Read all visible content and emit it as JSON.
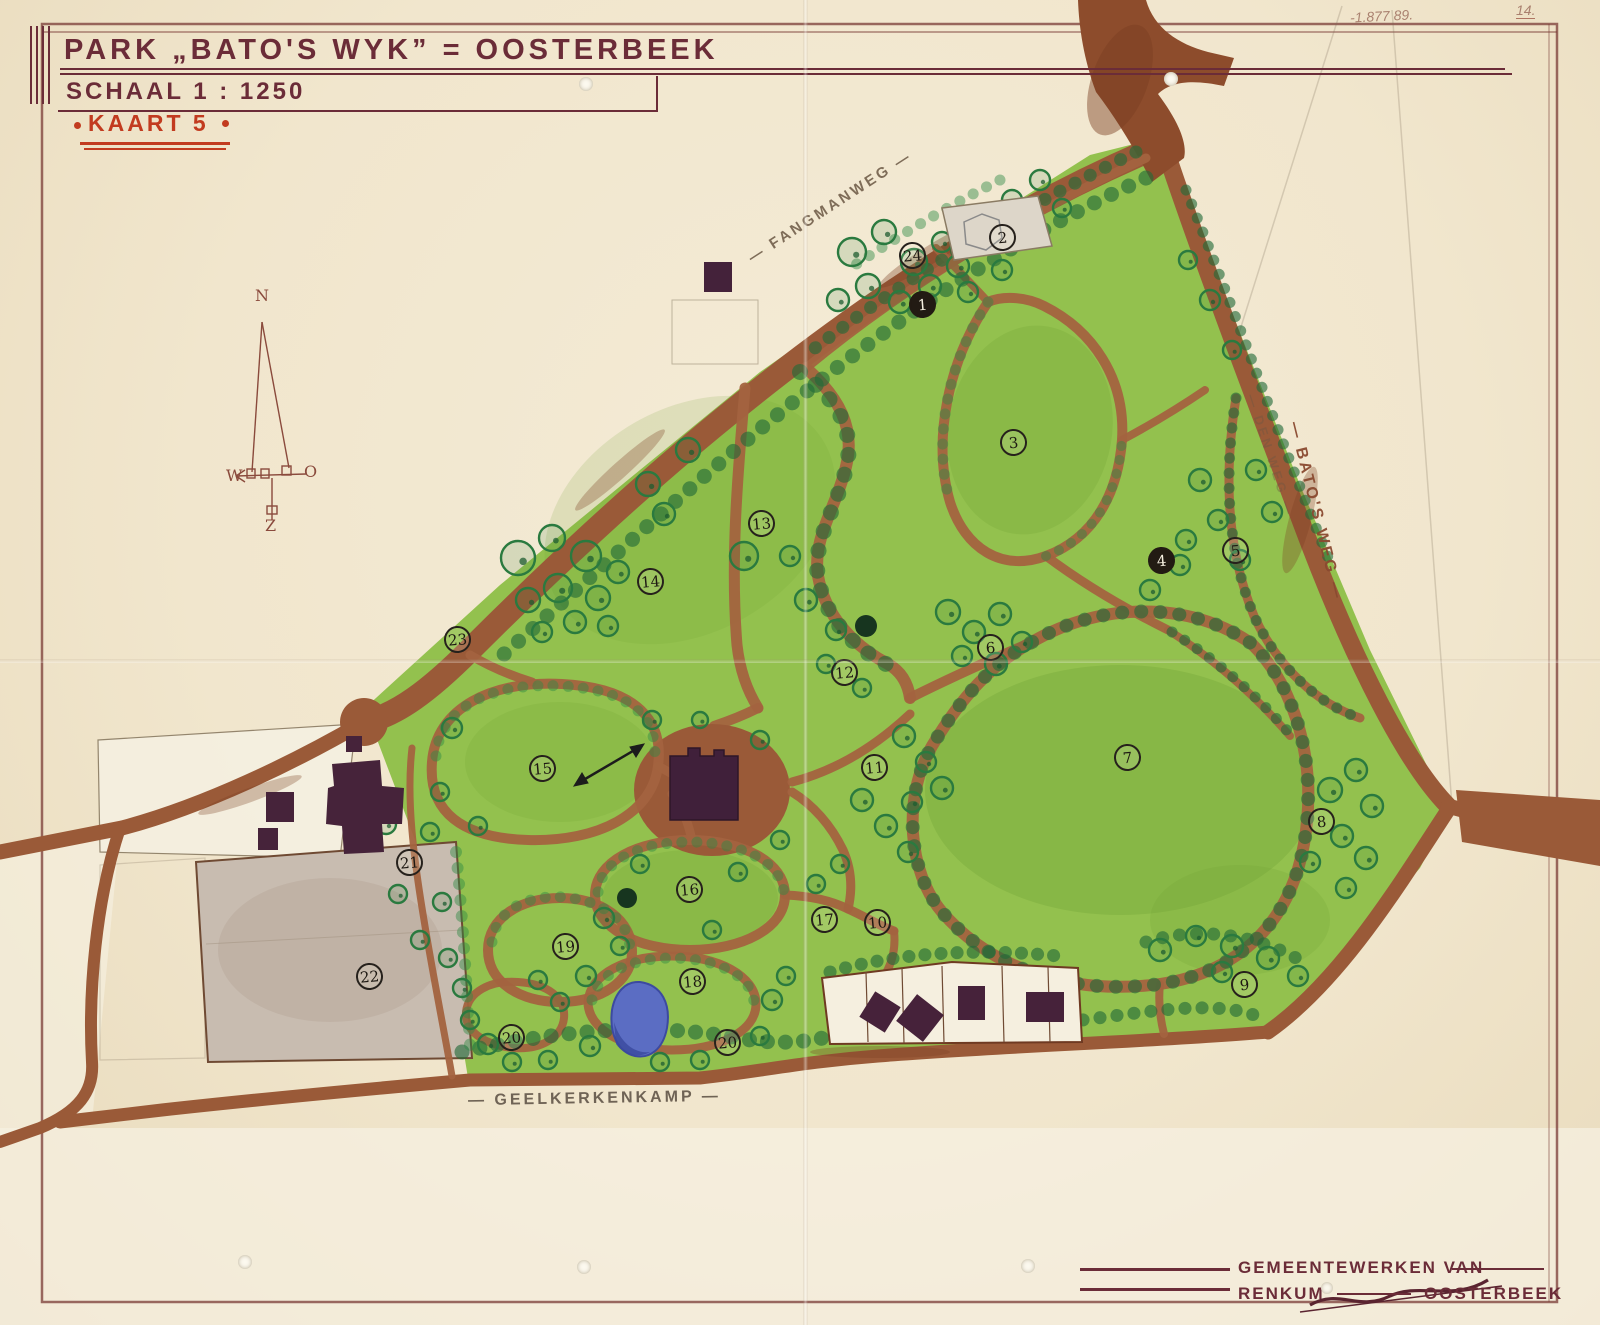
{
  "sheet": {
    "title": "PARK „BATO'S WYK” = OOSTERBEEK",
    "scale": "SCHAAL 1 : 1250",
    "map_no": "KAART 5",
    "pencil_note": "-1.877 89.",
    "pencil_page": "14.",
    "credit_line1": "GEMEENTEWERKEN VAN",
    "credit_left": "RENKUM",
    "credit_right": "OOSTERBEEK"
  },
  "streets": {
    "fangmanweg": "— FANGMANWEG —",
    "batosweg": "— BATO'S WEG —",
    "batosweg_pencil": "— DEN WEG —",
    "geelkerkenkamp": "— GEELKERKENKAMP —"
  },
  "compass": {
    "n": "N",
    "o": "O",
    "z": "Z",
    "w": "W"
  },
  "markers": [
    {
      "n": "1",
      "x": 923,
      "y": 305,
      "filled": true
    },
    {
      "n": "2",
      "x": 1003,
      "y": 238,
      "filled": false
    },
    {
      "n": "3",
      "x": 1014,
      "y": 443,
      "filled": false
    },
    {
      "n": "4",
      "x": 1162,
      "y": 561,
      "filled": true
    },
    {
      "n": "5",
      "x": 1236,
      "y": 551,
      "filled": false
    },
    {
      "n": "6",
      "x": 991,
      "y": 648,
      "filled": false
    },
    {
      "n": "7",
      "x": 1128,
      "y": 758,
      "filled": false
    },
    {
      "n": "8",
      "x": 1322,
      "y": 822,
      "filled": false
    },
    {
      "n": "9",
      "x": 1245,
      "y": 985,
      "filled": false
    },
    {
      "n": "10",
      "x": 878,
      "y": 923,
      "filled": false
    },
    {
      "n": "11",
      "x": 875,
      "y": 768,
      "filled": false
    },
    {
      "n": "12",
      "x": 845,
      "y": 673,
      "filled": false
    },
    {
      "n": "13",
      "x": 762,
      "y": 524,
      "filled": false
    },
    {
      "n": "14",
      "x": 651,
      "y": 582,
      "filled": false
    },
    {
      "n": "15",
      "x": 543,
      "y": 769,
      "filled": false
    },
    {
      "n": "16",
      "x": 690,
      "y": 890,
      "filled": false
    },
    {
      "n": "17",
      "x": 825,
      "y": 920,
      "filled": false
    },
    {
      "n": "18",
      "x": 693,
      "y": 982,
      "filled": false
    },
    {
      "n": "19",
      "x": 566,
      "y": 947,
      "filled": false
    },
    {
      "n": "20",
      "x": 512,
      "y": 1038,
      "filled": false
    },
    {
      "n": "20",
      "x": 728,
      "y": 1043,
      "filled": false
    },
    {
      "n": "21",
      "x": 410,
      "y": 863,
      "filled": false
    },
    {
      "n": "22",
      "x": 370,
      "y": 977,
      "filled": false
    },
    {
      "n": "23",
      "x": 458,
      "y": 640,
      "filled": false
    },
    {
      "n": "24",
      "x": 913,
      "y": 256,
      "filled": false
    }
  ],
  "colors": {
    "paper": "#f1e7cf",
    "road": "#9a5a38",
    "lawn": "#93c14e",
    "trees": "#226b38",
    "ink": "#6b2c38",
    "stamp": "#c23b1f",
    "pond": "#5b6dc3",
    "building": "#44223a",
    "parcel_grey": "#c8bcb0"
  }
}
